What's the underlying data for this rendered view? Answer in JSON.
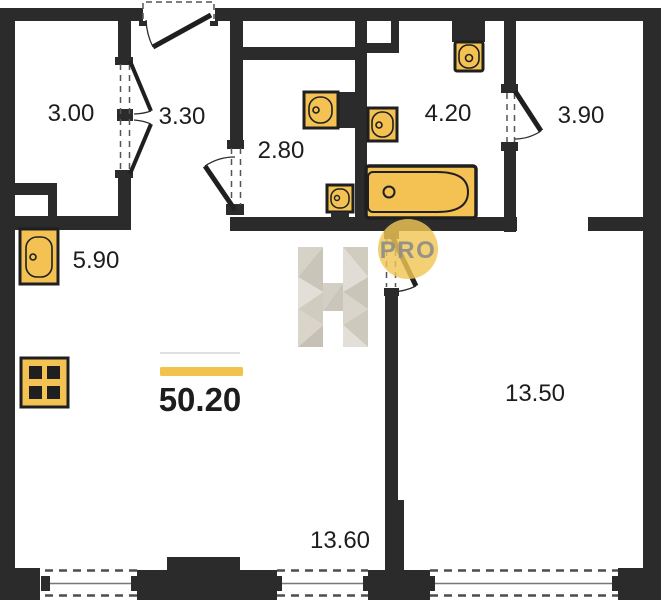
{
  "plan": {
    "total_area": "50.20",
    "room_areas": [
      "3.00",
      "3.30",
      "2.80",
      "4.20",
      "3.90",
      "5.90",
      "13.50",
      "13.60"
    ],
    "watermark": {
      "logo_letter": "H",
      "badge": "PRO"
    },
    "colors": {
      "wall": "#2b2b2b",
      "fixture_fill": "#f3c253",
      "accent": "#f2c14e"
    },
    "fixture_icons": [
      "kitchen-sink",
      "stove",
      "sink",
      "toilet",
      "bathtub",
      "window",
      "door"
    ]
  }
}
